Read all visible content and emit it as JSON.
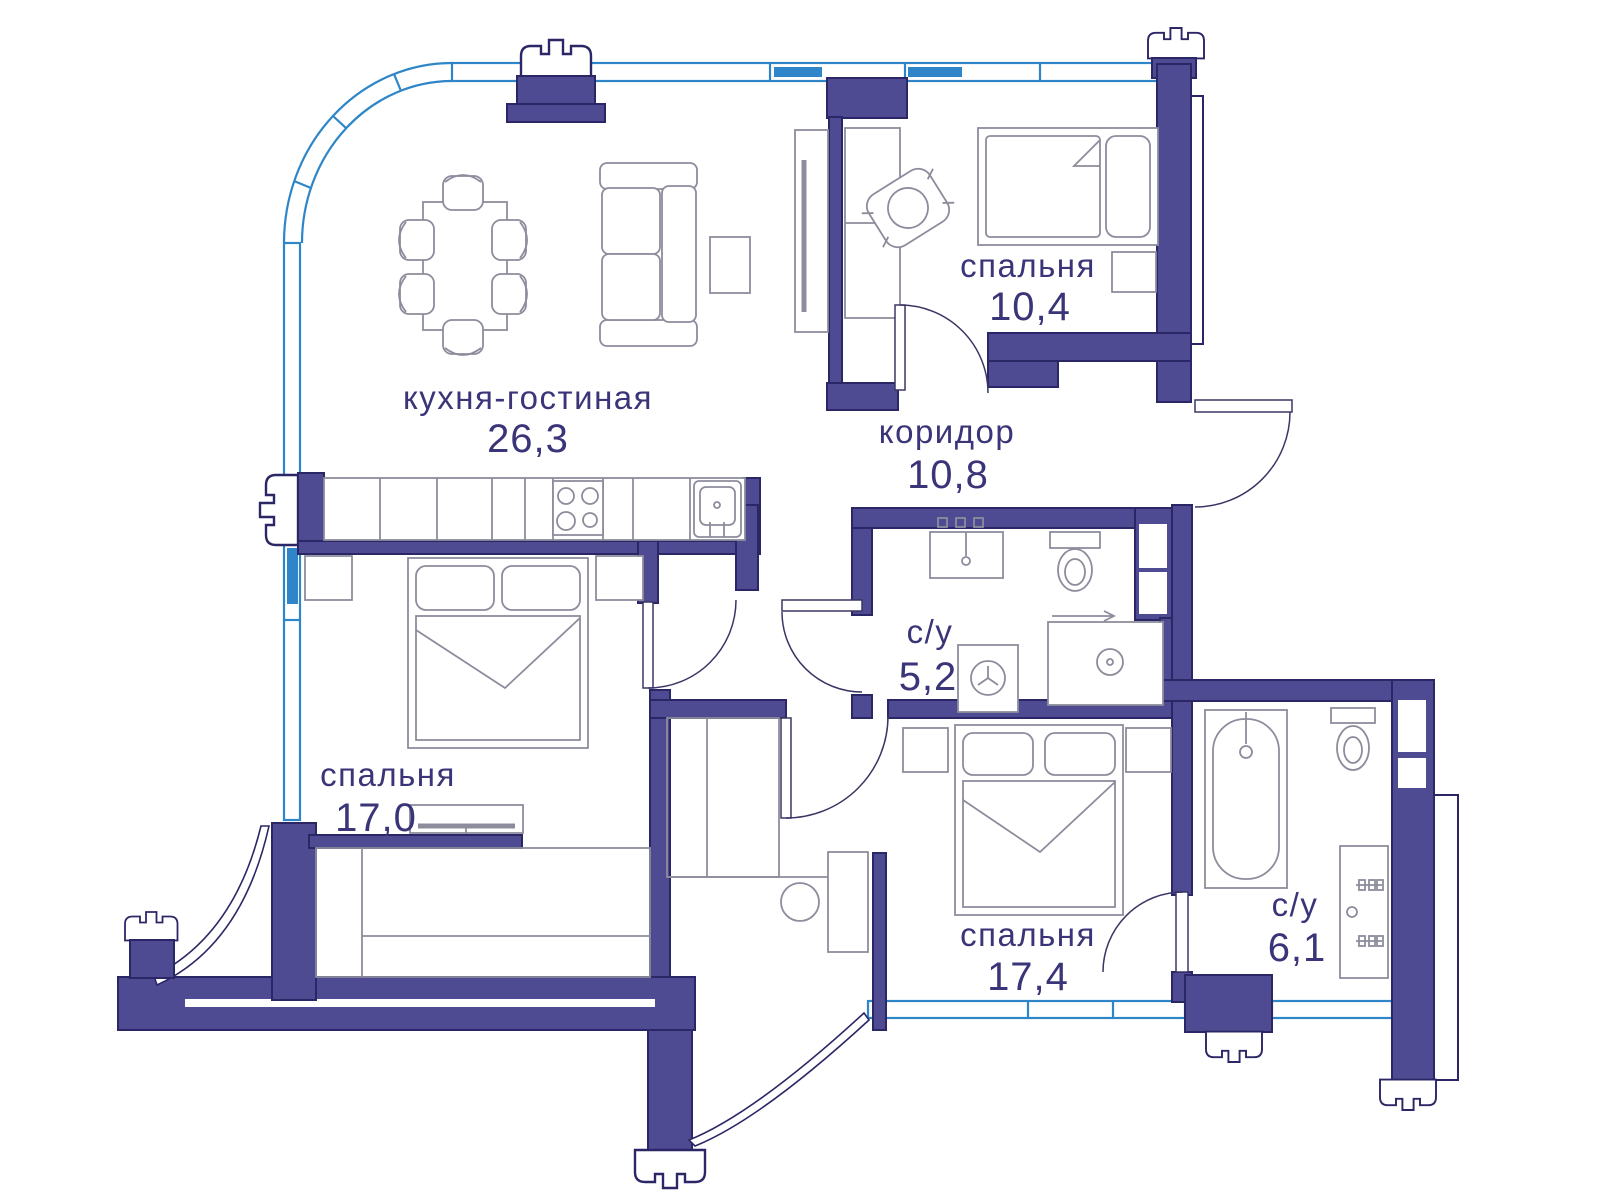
{
  "plan": {
    "rooms": [
      {
        "name": "кухня-гостиная",
        "area": "26,3"
      },
      {
        "name": "спальня",
        "area": "10,4"
      },
      {
        "name": "коридор",
        "area": "10,8"
      },
      {
        "name": "с/у",
        "area": "5,2"
      },
      {
        "name": "спальня",
        "area": "17,0"
      },
      {
        "name": "спальня",
        "area": "17,4"
      },
      {
        "name": "с/у",
        "area": "6,1"
      }
    ],
    "colors": {
      "wall": "#4F4B93",
      "wall_dark": "#2B2766",
      "window": "#2E86C8",
      "window_light": "#A8D8F0",
      "furniture": "#8C8C9C",
      "door": "#3A3664",
      "label": "#3A3478",
      "bg": "#FFFFFF"
    }
  }
}
